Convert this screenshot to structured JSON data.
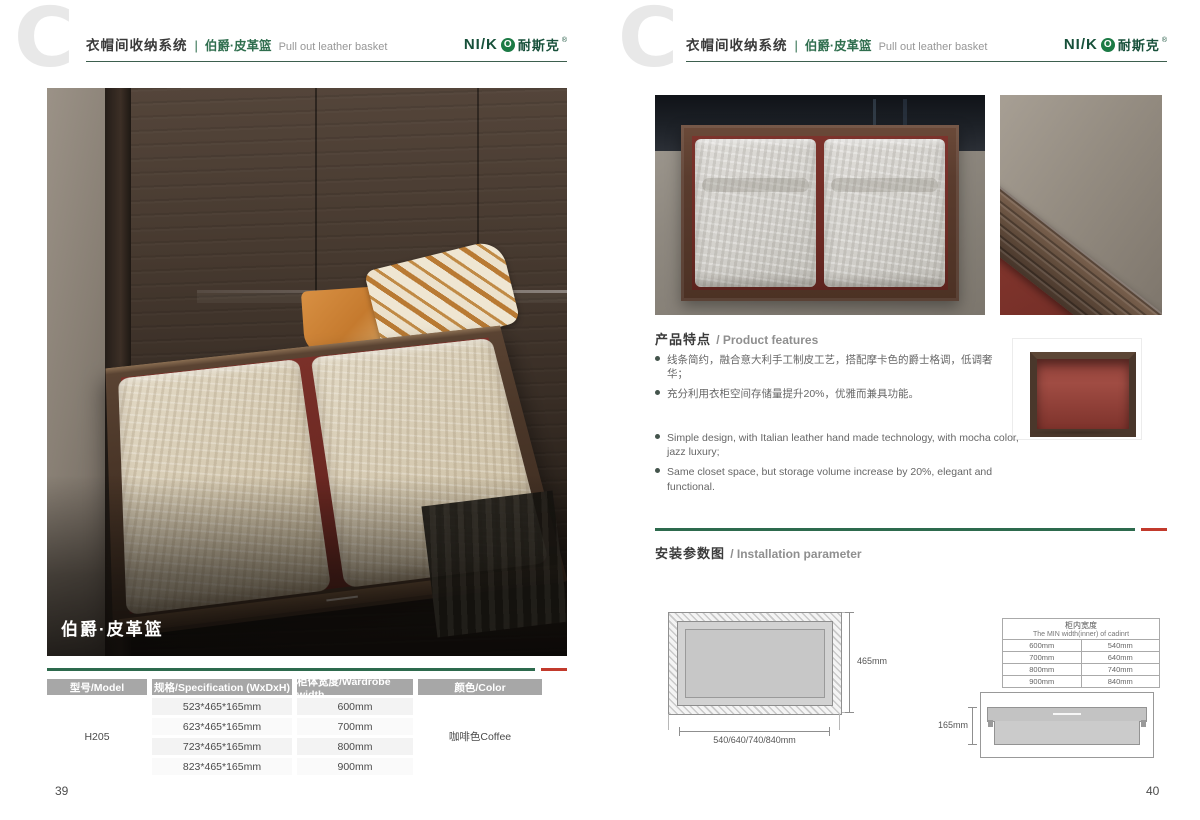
{
  "colors": {
    "brand_green": "#17503a",
    "divider_green": "#2d6a4d",
    "accent_red": "#c23a2c",
    "table_header_gray": "#a7a7a7"
  },
  "brand": {
    "logo_prefix": "NI/K",
    "logo_o": "O",
    "logo_cn": "耐斯克",
    "registered": "®"
  },
  "header": {
    "watermark_letter": "C",
    "title_cn": "衣帽间收纳系统",
    "separator": "|",
    "subtitle_cn": "伯爵·皮革篮",
    "subtitle_en": "Pull out leather basket"
  },
  "left_page": {
    "photo_caption": "伯爵·皮革篮",
    "page_number": "39",
    "table": {
      "headers": [
        "型号/Model",
        "规格/Specification (WxDxH)",
        "柜体宽度/Wardrobe width",
        "颜色/Color"
      ],
      "model": "H205",
      "rows": [
        {
          "spec": "523*465*165mm",
          "width": "600mm"
        },
        {
          "spec": "623*465*165mm",
          "width": "700mm"
        },
        {
          "spec": "723*465*165mm",
          "width": "800mm"
        },
        {
          "spec": "823*465*165mm",
          "width": "900mm"
        }
      ],
      "color": "咖啡色Coffee"
    }
  },
  "right_page": {
    "page_number": "40",
    "features": {
      "heading_cn": "产品特点",
      "heading_en": "/ Product features",
      "bullets_cn": [
        "线条简约，融合意大利手工制皮工艺，搭配摩卡色的爵士格调，低调奢华；",
        "充分利用衣柜空间存储量提升20%，优雅而兼具功能。"
      ],
      "bullets_en": [
        "Simple design, with Italian leather hand made technology, with mocha color, jazz luxury;",
        "Same closet space, but storage volume increase by 20%, elegant and functional."
      ]
    },
    "installation": {
      "heading_cn": "安装参数图",
      "heading_en": "/ Installation parameter",
      "top_view": {
        "height_label": "465mm",
        "width_label": "540/640/740/840mm"
      },
      "min_width_table": {
        "title_cn": "柜内宽度",
        "title_en": "The MIN width(inner) of cadinrt",
        "rows": [
          [
            "600mm",
            "540mm"
          ],
          [
            "700mm",
            "640mm"
          ],
          [
            "800mm",
            "740mm"
          ],
          [
            "900mm",
            "840mm"
          ]
        ]
      },
      "side_view": {
        "height_label": "165mm"
      }
    }
  }
}
